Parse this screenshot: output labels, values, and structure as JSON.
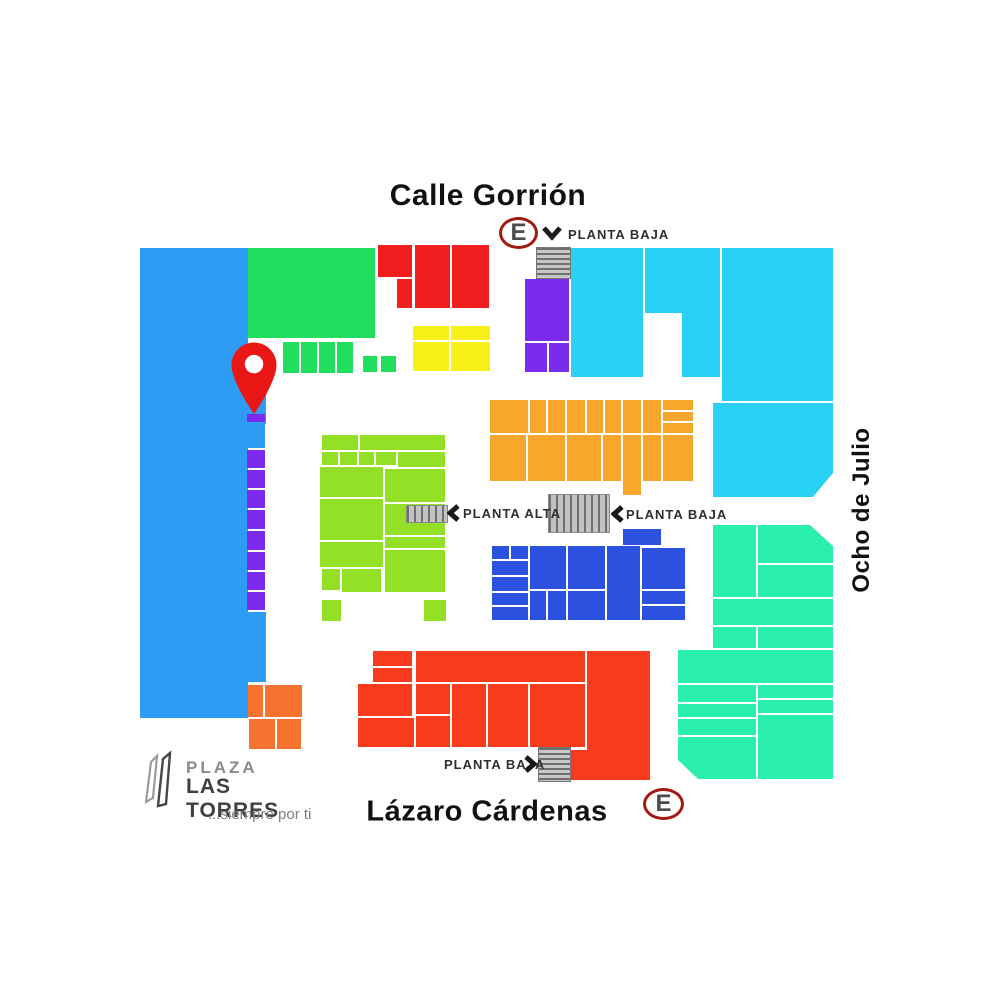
{
  "streets": {
    "top": "Calle Gorrión",
    "bottom": "Lázaro Cárdenas",
    "right": "Ocho de Julio"
  },
  "entrance_label": "E",
  "floor_labels": {
    "top": "PLANTA BAJA",
    "mid_left": "PLANTA ALTA",
    "mid_right": "PLANTA BAJA",
    "bottom": "PLANTA BAJA"
  },
  "logo": {
    "line1": "PLAZA",
    "line2": "LAS TORRES",
    "tagline": "...siempre por ti"
  },
  "colors": {
    "sky": "#2D9CF2",
    "green": "#21DE5F",
    "red": "#F01E1E",
    "yellow": "#F9F019",
    "cyan": "#29D1F4",
    "purple": "#7A2BEE",
    "orange": "#F7A72B",
    "chartreuse": "#93E026",
    "royal": "#2B51DE",
    "tomato": "#F83A1D",
    "mint": "#2BEFAD",
    "tangerine": "#F7722F",
    "pin_red": "#EB1616",
    "ring_red": "#A21B10",
    "letter_gray": "#4D4D4D"
  },
  "blocks": [
    {
      "c": "sky",
      "x": 140,
      "y": 248,
      "w": 108,
      "h": 470
    },
    {
      "c": "sky",
      "x": 246,
      "y": 390,
      "w": 20,
      "h": 34
    },
    {
      "c": "sky",
      "x": 247,
      "y": 424,
      "w": 18,
      "h": 24
    },
    {
      "c": "sky",
      "x": 246,
      "y": 612,
      "w": 20,
      "h": 70
    },
    {
      "c": "purple",
      "x": 247,
      "y": 414,
      "w": 18,
      "h": 8
    },
    {
      "c": "purple",
      "x": 247,
      "y": 450,
      "w": 18,
      "h": 18
    },
    {
      "c": "purple",
      "x": 247,
      "y": 470,
      "w": 18,
      "h": 18
    },
    {
      "c": "purple",
      "x": 247,
      "y": 490,
      "w": 18,
      "h": 18
    },
    {
      "c": "purple",
      "x": 247,
      "y": 510,
      "w": 18,
      "h": 19
    },
    {
      "c": "purple",
      "x": 247,
      "y": 531,
      "w": 18,
      "h": 19
    },
    {
      "c": "purple",
      "x": 247,
      "y": 552,
      "w": 18,
      "h": 18
    },
    {
      "c": "purple",
      "x": 247,
      "y": 572,
      "w": 18,
      "h": 18
    },
    {
      "c": "purple",
      "x": 247,
      "y": 592,
      "w": 18,
      "h": 18
    },
    {
      "c": "green",
      "x": 248,
      "y": 248,
      "w": 127,
      "h": 90
    },
    {
      "c": "green",
      "x": 283,
      "y": 342,
      "w": 16,
      "h": 31
    },
    {
      "c": "green",
      "x": 301,
      "y": 342,
      "w": 16,
      "h": 31
    },
    {
      "c": "green",
      "x": 319,
      "y": 342,
      "w": 16,
      "h": 31
    },
    {
      "c": "green",
      "x": 337,
      "y": 342,
      "w": 16,
      "h": 31
    },
    {
      "c": "green",
      "x": 363,
      "y": 356,
      "w": 14,
      "h": 16
    },
    {
      "c": "green",
      "x": 381,
      "y": 356,
      "w": 15,
      "h": 16
    },
    {
      "c": "red",
      "x": 378,
      "y": 245,
      "w": 34,
      "h": 32
    },
    {
      "c": "red",
      "x": 397,
      "y": 279,
      "w": 15,
      "h": 29
    },
    {
      "c": "red",
      "x": 415,
      "y": 245,
      "w": 35,
      "h": 63
    },
    {
      "c": "red",
      "x": 452,
      "y": 245,
      "w": 37,
      "h": 63
    },
    {
      "c": "yellow",
      "x": 413,
      "y": 326,
      "w": 36,
      "h": 14
    },
    {
      "c": "yellow",
      "x": 451,
      "y": 326,
      "w": 39,
      "h": 14
    },
    {
      "c": "yellow",
      "x": 413,
      "y": 342,
      "w": 36,
      "h": 29
    },
    {
      "c": "yellow",
      "x": 451,
      "y": 342,
      "w": 39,
      "h": 29
    },
    {
      "c": "purple",
      "x": 525,
      "y": 279,
      "w": 44,
      "h": 62
    },
    {
      "c": "purple",
      "x": 525,
      "y": 343,
      "w": 22,
      "h": 29
    },
    {
      "c": "purple",
      "x": 549,
      "y": 343,
      "w": 20,
      "h": 29
    },
    {
      "t": "stairs-h split",
      "x": 536,
      "y": 247,
      "w": 33,
      "h": 30
    },
    {
      "c": "cyan",
      "x": 571,
      "y": 248,
      "w": 72,
      "h": 129
    },
    {
      "c": "cyan",
      "x": 645,
      "y": 248,
      "w": 75,
      "h": 129,
      "p": [
        [
          0,
          0
        ],
        [
          75,
          0
        ],
        [
          75,
          129
        ],
        [
          37,
          129
        ],
        [
          37,
          65
        ],
        [
          0,
          65
        ]
      ]
    },
    {
      "c": "cyan",
      "x": 722,
      "y": 248,
      "w": 111,
      "h": 153
    },
    {
      "c": "cyan",
      "x": 713,
      "y": 403,
      "w": 120,
      "h": 94,
      "p": [
        [
          0,
          0
        ],
        [
          120,
          0
        ],
        [
          120,
          70
        ],
        [
          100,
          94
        ],
        [
          0,
          94
        ]
      ]
    },
    {
      "c": "orange",
      "x": 490,
      "y": 400,
      "w": 38,
      "h": 33
    },
    {
      "c": "orange",
      "x": 530,
      "y": 400,
      "w": 16,
      "h": 33
    },
    {
      "c": "orange",
      "x": 548,
      "y": 400,
      "w": 17,
      "h": 33
    },
    {
      "c": "orange",
      "x": 567,
      "y": 400,
      "w": 18,
      "h": 33
    },
    {
      "c": "orange",
      "x": 587,
      "y": 400,
      "w": 16,
      "h": 33
    },
    {
      "c": "orange",
      "x": 605,
      "y": 400,
      "w": 16,
      "h": 33
    },
    {
      "c": "orange",
      "x": 623,
      "y": 400,
      "w": 18,
      "h": 33
    },
    {
      "c": "orange",
      "x": 643,
      "y": 400,
      "w": 18,
      "h": 33
    },
    {
      "c": "orange",
      "x": 663,
      "y": 400,
      "w": 30,
      "h": 10
    },
    {
      "c": "orange",
      "x": 663,
      "y": 412,
      "w": 30,
      "h": 9
    },
    {
      "c": "orange",
      "x": 663,
      "y": 423,
      "w": 30,
      "h": 10
    },
    {
      "c": "orange",
      "x": 490,
      "y": 435,
      "w": 36,
      "h": 46
    },
    {
      "c": "orange",
      "x": 528,
      "y": 435,
      "w": 37,
      "h": 46
    },
    {
      "c": "orange",
      "x": 567,
      "y": 435,
      "w": 34,
      "h": 46
    },
    {
      "c": "orange",
      "x": 603,
      "y": 435,
      "w": 18,
      "h": 46
    },
    {
      "c": "orange",
      "x": 623,
      "y": 435,
      "w": 18,
      "h": 60
    },
    {
      "c": "orange",
      "x": 643,
      "y": 435,
      "w": 18,
      "h": 46
    },
    {
      "c": "orange",
      "x": 663,
      "y": 435,
      "w": 30,
      "h": 46
    },
    {
      "c": "chartreuse",
      "x": 322,
      "y": 435,
      "w": 36,
      "h": 15
    },
    {
      "c": "chartreuse",
      "x": 360,
      "y": 435,
      "w": 85,
      "h": 15
    },
    {
      "c": "chartreuse",
      "x": 322,
      "y": 452,
      "w": 16,
      "h": 13
    },
    {
      "c": "chartreuse",
      "x": 340,
      "y": 452,
      "w": 17,
      "h": 13
    },
    {
      "c": "chartreuse",
      "x": 359,
      "y": 452,
      "w": 15,
      "h": 13
    },
    {
      "c": "chartreuse",
      "x": 376,
      "y": 452,
      "w": 20,
      "h": 13
    },
    {
      "c": "chartreuse",
      "x": 398,
      "y": 452,
      "w": 47,
      "h": 15
    },
    {
      "c": "chartreuse",
      "x": 320,
      "y": 467,
      "w": 63,
      "h": 30
    },
    {
      "c": "chartreuse",
      "x": 320,
      "y": 499,
      "w": 63,
      "h": 41
    },
    {
      "c": "chartreuse",
      "x": 320,
      "y": 542,
      "w": 63,
      "h": 25
    },
    {
      "c": "chartreuse",
      "x": 322,
      "y": 569,
      "w": 18,
      "h": 21
    },
    {
      "c": "chartreuse",
      "x": 342,
      "y": 569,
      "w": 39,
      "h": 23
    },
    {
      "c": "chartreuse",
      "x": 385,
      "y": 469,
      "w": 60,
      "h": 33
    },
    {
      "c": "chartreuse",
      "x": 385,
      "y": 504,
      "w": 60,
      "h": 31
    },
    {
      "c": "chartreuse",
      "x": 385,
      "y": 537,
      "w": 60,
      "h": 11
    },
    {
      "c": "chartreuse",
      "x": 385,
      "y": 550,
      "w": 60,
      "h": 42
    },
    {
      "c": "chartreuse",
      "x": 322,
      "y": 600,
      "w": 19,
      "h": 21
    },
    {
      "c": "chartreuse",
      "x": 424,
      "y": 600,
      "w": 22,
      "h": 21
    },
    {
      "t": "stairs-v",
      "x": 406,
      "y": 505,
      "w": 40,
      "h": 16
    },
    {
      "t": "stairs-v",
      "x": 548,
      "y": 494,
      "w": 60,
      "h": 37
    },
    {
      "c": "royal",
      "x": 623,
      "y": 529,
      "w": 38,
      "h": 16
    },
    {
      "c": "royal",
      "x": 492,
      "y": 546,
      "w": 17,
      "h": 13
    },
    {
      "c": "royal",
      "x": 511,
      "y": 546,
      "w": 17,
      "h": 13
    },
    {
      "c": "royal",
      "x": 492,
      "y": 561,
      "w": 36,
      "h": 14
    },
    {
      "c": "royal",
      "x": 492,
      "y": 577,
      "w": 36,
      "h": 14
    },
    {
      "c": "royal",
      "x": 492,
      "y": 593,
      "w": 36,
      "h": 12
    },
    {
      "c": "royal",
      "x": 492,
      "y": 607,
      "w": 36,
      "h": 13
    },
    {
      "c": "royal",
      "x": 530,
      "y": 546,
      "w": 36,
      "h": 43
    },
    {
      "c": "royal",
      "x": 568,
      "y": 546,
      "w": 37,
      "h": 43
    },
    {
      "c": "royal",
      "x": 530,
      "y": 591,
      "w": 16,
      "h": 29
    },
    {
      "c": "royal",
      "x": 548,
      "y": 591,
      "w": 18,
      "h": 29
    },
    {
      "c": "royal",
      "x": 568,
      "y": 591,
      "w": 37,
      "h": 29
    },
    {
      "c": "royal",
      "x": 607,
      "y": 546,
      "w": 33,
      "h": 74
    },
    {
      "c": "royal",
      "x": 642,
      "y": 548,
      "w": 43,
      "h": 41
    },
    {
      "c": "royal",
      "x": 642,
      "y": 591,
      "w": 43,
      "h": 13
    },
    {
      "c": "royal",
      "x": 642,
      "y": 606,
      "w": 43,
      "h": 14
    },
    {
      "c": "tomato",
      "x": 373,
      "y": 651,
      "w": 39,
      "h": 15
    },
    {
      "c": "tomato",
      "x": 373,
      "y": 668,
      "w": 39,
      "h": 14
    },
    {
      "c": "tomato",
      "x": 358,
      "y": 684,
      "w": 54,
      "h": 32
    },
    {
      "c": "tomato",
      "x": 358,
      "y": 718,
      "w": 56,
      "h": 29
    },
    {
      "c": "tomato",
      "x": 416,
      "y": 651,
      "w": 169,
      "h": 31
    },
    {
      "c": "tomato",
      "x": 416,
      "y": 684,
      "w": 34,
      "h": 30
    },
    {
      "c": "tomato",
      "x": 416,
      "y": 716,
      "w": 34,
      "h": 31
    },
    {
      "c": "tomato",
      "x": 452,
      "y": 684,
      "w": 34,
      "h": 63
    },
    {
      "c": "tomato",
      "x": 488,
      "y": 684,
      "w": 40,
      "h": 63
    },
    {
      "c": "tomato",
      "x": 530,
      "y": 684,
      "w": 55,
      "h": 63
    },
    {
      "c": "tomato",
      "x": 569,
      "y": 651,
      "w": 81,
      "h": 129,
      "p": [
        [
          18,
          0
        ],
        [
          81,
          0
        ],
        [
          81,
          129
        ],
        [
          0,
          129
        ],
        [
          0,
          99
        ],
        [
          18,
          99
        ]
      ]
    },
    {
      "t": "stairs-h split",
      "x": 538,
      "y": 747,
      "w": 31,
      "h": 33
    },
    {
      "c": "mint",
      "x": 713,
      "y": 525,
      "w": 43,
      "h": 72
    },
    {
      "c": "mint",
      "x": 758,
      "y": 525,
      "w": 75,
      "h": 38,
      "p": [
        [
          0,
          0
        ],
        [
          52,
          0
        ],
        [
          75,
          21
        ],
        [
          75,
          38
        ],
        [
          0,
          38
        ]
      ]
    },
    {
      "c": "mint",
      "x": 758,
      "y": 565,
      "w": 75,
      "h": 32
    },
    {
      "c": "mint",
      "x": 713,
      "y": 599,
      "w": 120,
      "h": 26
    },
    {
      "c": "mint",
      "x": 713,
      "y": 627,
      "w": 43,
      "h": 21
    },
    {
      "c": "mint",
      "x": 758,
      "y": 627,
      "w": 75,
      "h": 21
    },
    {
      "c": "mint",
      "x": 678,
      "y": 650,
      "w": 155,
      "h": 33
    },
    {
      "c": "mint",
      "x": 678,
      "y": 685,
      "w": 78,
      "h": 17
    },
    {
      "c": "mint",
      "x": 758,
      "y": 685,
      "w": 75,
      "h": 13
    },
    {
      "c": "mint",
      "x": 758,
      "y": 700,
      "w": 75,
      "h": 13
    },
    {
      "c": "mint",
      "x": 678,
      "y": 704,
      "w": 78,
      "h": 13
    },
    {
      "c": "mint",
      "x": 678,
      "y": 719,
      "w": 78,
      "h": 16
    },
    {
      "c": "mint",
      "x": 678,
      "y": 737,
      "w": 78,
      "h": 42,
      "p": [
        [
          0,
          0
        ],
        [
          78,
          0
        ],
        [
          78,
          42
        ],
        [
          20,
          42
        ],
        [
          0,
          23
        ]
      ]
    },
    {
      "c": "mint",
      "x": 758,
      "y": 715,
      "w": 75,
      "h": 64
    },
    {
      "c": "tangerine",
      "x": 248,
      "y": 685,
      "w": 15,
      "h": 32
    },
    {
      "c": "tangerine",
      "x": 265,
      "y": 685,
      "w": 37,
      "h": 32
    },
    {
      "c": "tangerine",
      "x": 249,
      "y": 719,
      "w": 26,
      "h": 30
    },
    {
      "c": "tangerine",
      "x": 277,
      "y": 719,
      "w": 24,
      "h": 30
    }
  ]
}
